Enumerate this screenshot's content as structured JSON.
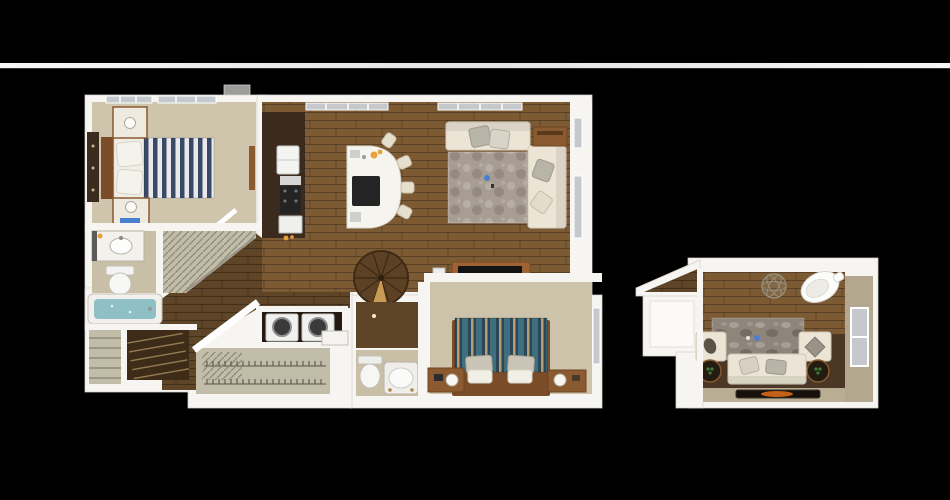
{
  "scene": {
    "title": "3D apartment floor plan rendering, two-level unit",
    "main_unit_label": "Main level floor plan",
    "bonus_unit_label": "Bonus room floor plan"
  },
  "palette": {
    "bg": "#000000",
    "stripA": "#f6f6f6",
    "stripB": "#e3e3e3",
    "wall": "#f7f5f1",
    "wallEdge": "#d6d1c8",
    "notch": "#9c9c9c",
    "carpet1": "#cfc5ac",
    "carpet2": "#cdc3aa",
    "bathFloor": "#c9bfa6",
    "closetFloor": "#c2bda8",
    "wood": "#7b5a34",
    "hallWood": "#5e4527",
    "darkFloor": "#4a3726",
    "cabinet": "#3b2b1f",
    "island": "#f6f4ef",
    "cooktop": "#242424",
    "rugGray": "#a79d92",
    "stoneRug": "#8e857b",
    "sofa": "#ece5d5",
    "pillowGray": "#b9b4a8",
    "accentWood": "#8a5a30",
    "bedFrame": "#7a4c28",
    "navy": "#3a4a66",
    "stripeWhite": "#e9e9ec",
    "teal": "#3f6f7e",
    "navy2": "#2c4656",
    "tanStripe": "#b59c74",
    "water": "#8fc0c6",
    "glass": "#c5c9cd",
    "tanWall": "#b3a78f",
    "fire": "#e2701c",
    "orange": "#e8a13a",
    "blueDecor": "#4a7fd0",
    "green": "#3f7d3f"
  },
  "units": {
    "main": {
      "label": "Main level floor plan",
      "rooms": [
        {
          "name": "bedroom-1",
          "furniture": [
            "striped-queen-bed",
            "nightstand-top",
            "nightstand-bottom",
            "dresser",
            "windows"
          ]
        },
        {
          "name": "bathroom-1",
          "furniture": [
            "vanity-sink",
            "toilet",
            "bathtub"
          ]
        },
        {
          "name": "walk-in-closet-1",
          "furniture": [
            "wire-shelving"
          ]
        },
        {
          "name": "kitchen",
          "furniture": [
            "refrigerator",
            "range",
            "dishwasher",
            "curved-island",
            "cooktop",
            "bar-stools"
          ]
        },
        {
          "name": "living-room",
          "furniture": [
            "sectional-sofa",
            "area-rug",
            "end-table",
            "tv-console",
            "windows"
          ]
        },
        {
          "name": "spiral-staircase",
          "furniture": []
        },
        {
          "name": "laundry-closet",
          "furniture": [
            "washer",
            "dryer"
          ]
        },
        {
          "name": "walk-in-closet-2",
          "furniture": [
            "wire-shelving",
            "counter"
          ]
        },
        {
          "name": "bathroom-2",
          "furniture": [
            "toilet",
            "garden-tub"
          ]
        },
        {
          "name": "bedroom-2",
          "furniture": [
            "striped-queen-bed",
            "nightstand-left",
            "nightstand-right",
            "window"
          ]
        },
        {
          "name": "entry-stairs",
          "furniture": []
        },
        {
          "name": "linen-closet",
          "furniture": [
            "shelves"
          ]
        }
      ]
    },
    "bonus": {
      "label": "Bonus room floor plan",
      "rooms": [
        {
          "name": "bonus-room",
          "furniture": [
            "sofa",
            "armchair-left",
            "armchair-right",
            "stone-rug",
            "side-tables",
            "egg-chair",
            "wire-sphere-decor",
            "fireplace",
            "window"
          ]
        },
        {
          "name": "bonus-closet",
          "furniture": []
        },
        {
          "name": "bonus-entry",
          "furniture": []
        }
      ]
    }
  }
}
